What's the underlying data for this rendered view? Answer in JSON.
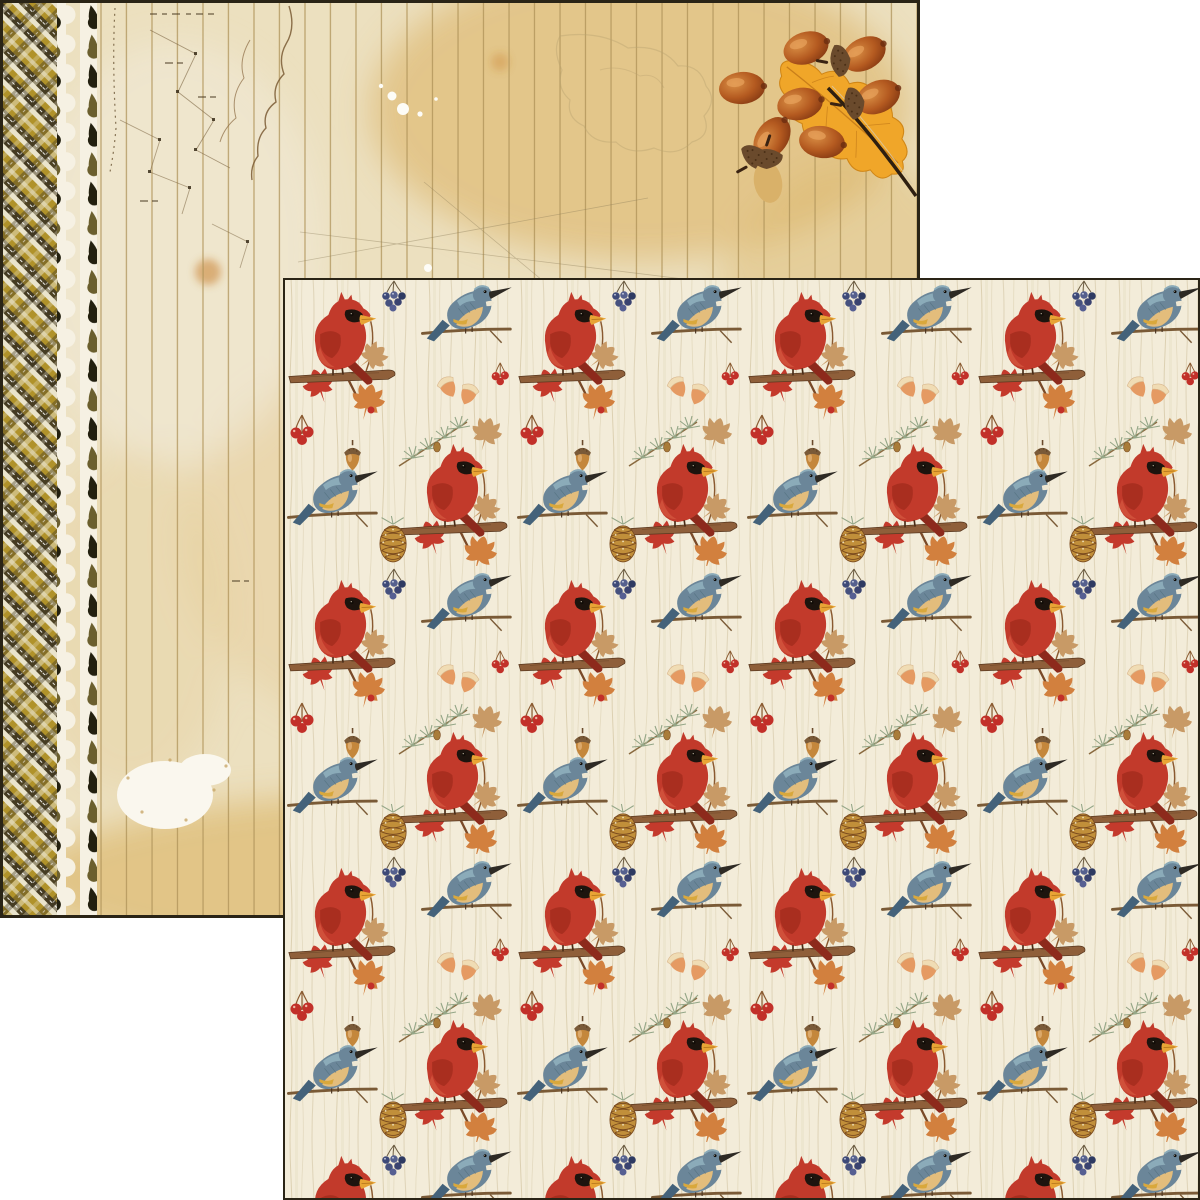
{
  "scene": {
    "description": "Two overlapping sheets of double-sided autumn scrapbook paper",
    "back_sheet_name": "vintage map notebook side with plaid edge, torn spiral holes, acorns and oak leaf",
    "front_sheet_name": "cardinals and kingfishers autumn pattern side"
  },
  "palette": {
    "page_bg": "#ffffff",
    "back_paper": "#ece0bf",
    "back_amber": "#d9ab58",
    "plank_line": "#a68a50",
    "plaid_olive": "#b0922a",
    "plaid_dark": "#3c3422",
    "plaid_cream": "#eae4cc",
    "hole_dark": "#23200f",
    "hole_olive": "#6b5f2e",
    "torn_white": "#f6f1e3",
    "map_ink": "#7a5a34",
    "front_bg": "#f3ecd9",
    "grain_line": "#d8ccab",
    "cardinal_red": "#c23a2b",
    "cardinal_wing": "#a52c1d",
    "cardinal_mask": "#1d140e",
    "cardinal_beak": "#e8a435",
    "kingfisher_blue": "#6b8699",
    "kingfisher_back": "#8fb0bd",
    "kingfisher_chest": "#e3bd7c",
    "branch_brown": "#8f5f3a",
    "leaf_orange": "#d2803e",
    "leaf_red": "#c43a2c",
    "leaf_tan": "#c89a66",
    "pinecone_gold": "#c18f3a",
    "pinecone_line": "#7a4a1e",
    "sprig_green": "#94a687",
    "berry_red": "#c23029",
    "berry_blue": "#3e4a78",
    "acorn_body": "#c4873c",
    "acorn_cap": "#7a5a38",
    "acorn_pair_orange": "#e59a62",
    "big_acorn_deep": "#b45a20",
    "oak_leaf": "#f0a629",
    "border_dark": "#2a2416"
  },
  "front_sheet": {
    "motifs": [
      "cardinal on branch",
      "kingfisher on branch",
      "maple leaves",
      "pine cone",
      "pine sprig",
      "acorn",
      "orange acorn pair",
      "red berries",
      "blue berries"
    ],
    "background_texture": "cream woodgrain"
  },
  "back_sheet": {
    "elements": [
      "olive tartan plaid edge",
      "torn white spiral-bound edge with punched holes",
      "vertical plank lines",
      "faded vintage map with dotted routes",
      "amber stains",
      "white paint splatter",
      "acorn cluster",
      "golden oak leaf on twig"
    ]
  }
}
